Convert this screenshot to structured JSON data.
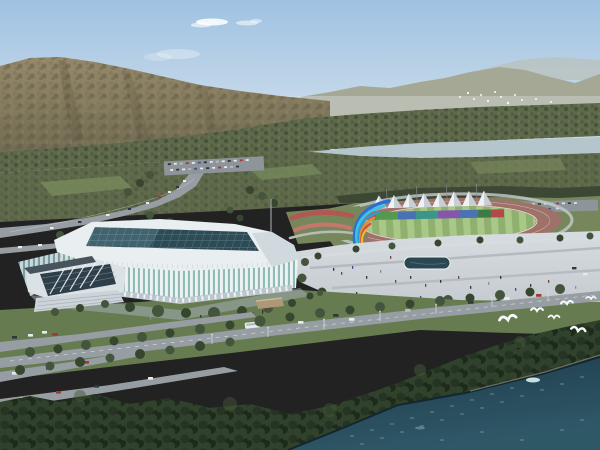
{
  "scene": {
    "type": "aerial architectural rendering",
    "description": "Bird's-eye rendering of a lakeside sports complex: a white lattice-framed indoor arena with a dark glass grid roof, an outdoor athletics track with a row of white peaked canopies above rainbow-colored wall panels, a blue-and-orange ribbon sculpture on a paved plaza, tree-lined boulevards with light traffic, a forested mountain and hazy ridges behind a river strip, and dark blue water with white gulls in the foreground.",
    "landmarks": {
      "arena": "indoor-arena",
      "stadium": "athletics-stadium",
      "sculpture": "ribbon-flame-sculpture",
      "plaza": "waterfront-plaza",
      "pool": "reflecting-pool",
      "river": "river-strip",
      "mountain": "forested-mountain",
      "water": "foreground-lake"
    },
    "counts": {
      "canopy_tents": 8,
      "foreground_gulls": 6,
      "distant_birds": 17
    }
  },
  "colors": {
    "sky-top": "#9fc2e2",
    "sky-horizon": "#e4eaee",
    "cloud": "#ffffff",
    "mtn-hi": "#97896b",
    "mtn-lo": "#6d6950",
    "mtn-a": "#7c7458",
    "mtn-b": "#5e5a42",
    "mtn-c": "#8f8366",
    "mtn-streak": "#4a452f",
    "ridge-far": "#a6a896",
    "ridge-farther": "#b9bdb0",
    "haze": "#dfe4e4",
    "belt-base": "#5f6a4b",
    "belt-a": "#4d5940",
    "belt-b": "#6a7650",
    "belt-c": "#3f4b36",
    "river": "#b4c5cc",
    "grass-mid": "#76885b",
    "grass-fore": "#677b50",
    "road": "#969ea3",
    "road-line": "#f2f4f5",
    "parking": "#8d959a",
    "car-dark": "#2f3640",
    "car-white": "#e8eaec",
    "car-red": "#9c3a36",
    "car-blue": "#3c5a7c",
    "car-silver": "#b9bdbf",
    "track": "#9e7268",
    "infield-a": "#8fb06f",
    "infield-b": "#a9c787",
    "ringroad": "#c6cbce",
    "track-line": "#ffffff",
    "tent": "#eef2f4",
    "tent-shade": "#c7ced4",
    "tent-pole": "#8a9298",
    "canopy-dark": "#3c4833",
    "panel1": "#9c4a50",
    "panel2": "#c05058",
    "panel3": "#56984e",
    "panel4": "#4a70b6",
    "panel5": "#3b968a",
    "panel6": "#8656ae",
    "panel7": "#4a72b8",
    "panel8": "#3d7a46",
    "panel9": "#b24a48",
    "flower-a": "#b25852",
    "flower-b": "#c4786c",
    "flower-path": "#b7bcb9",
    "plaza-hi": "#d6dce0",
    "plaza-lo": "#c2c8cd",
    "plaza-line": "#adb4ba",
    "pool": "#2a4752",
    "pool-rim": "#eef1f3",
    "people-a": "#2e3338",
    "people-b": "#6b4a3a",
    "people-c": "#37517a",
    "people-d": "#8a8f96",
    "tree-row": "#43553c",
    "tree-row-dark": "#36462f",
    "arena-rim": "#e9eef1",
    "arena-rim-shade": "#c9d3d8",
    "roof-glass": "#2e4a54",
    "roof-grid": "#63909c",
    "roof-sheen": "#8fc0cc",
    "arena-rib": "#eef2f4",
    "arena-glass": "#8fbcb4",
    "arena-rib-sh": "#cdd7db",
    "arena-glass-sh": "#749ea0",
    "colonnade": "#bcc6cc",
    "plinth": "#a3adb2",
    "entry-face": "#dae2e6",
    "entry-glass": "#2f3f4a",
    "entry-line": "#71879a",
    "entry-canopy": "#47545c",
    "steps": "#ccd4d9",
    "step-line": "#a9b3b9",
    "pavilion": "#ae9878",
    "pavilion-roof": "#c9b896",
    "fg-a": "#263424",
    "fg-b": "#31422c",
    "fg-c": "#1d2a1c",
    "fg-hi": "#46593a",
    "water-top": "#1d3a49",
    "water-bot": "#2f5867",
    "sparkle": "#dceef2",
    "shore": "#142630",
    "sand": "#7d8070",
    "gull": "#f6f9fa",
    "pole": "#d3d9dd",
    "mast": "#959da3",
    "s-blue": "#2b6fd0",
    "s-cyan": "#3cc2ea",
    "s-teal": "#2aa0c8",
    "s-orange": "#e8883a",
    "s-red": "#d4503a",
    "s-yellow": "#e6c23c",
    "s-base": "#3c434c",
    "s-plinth": "#a2aab0"
  }
}
